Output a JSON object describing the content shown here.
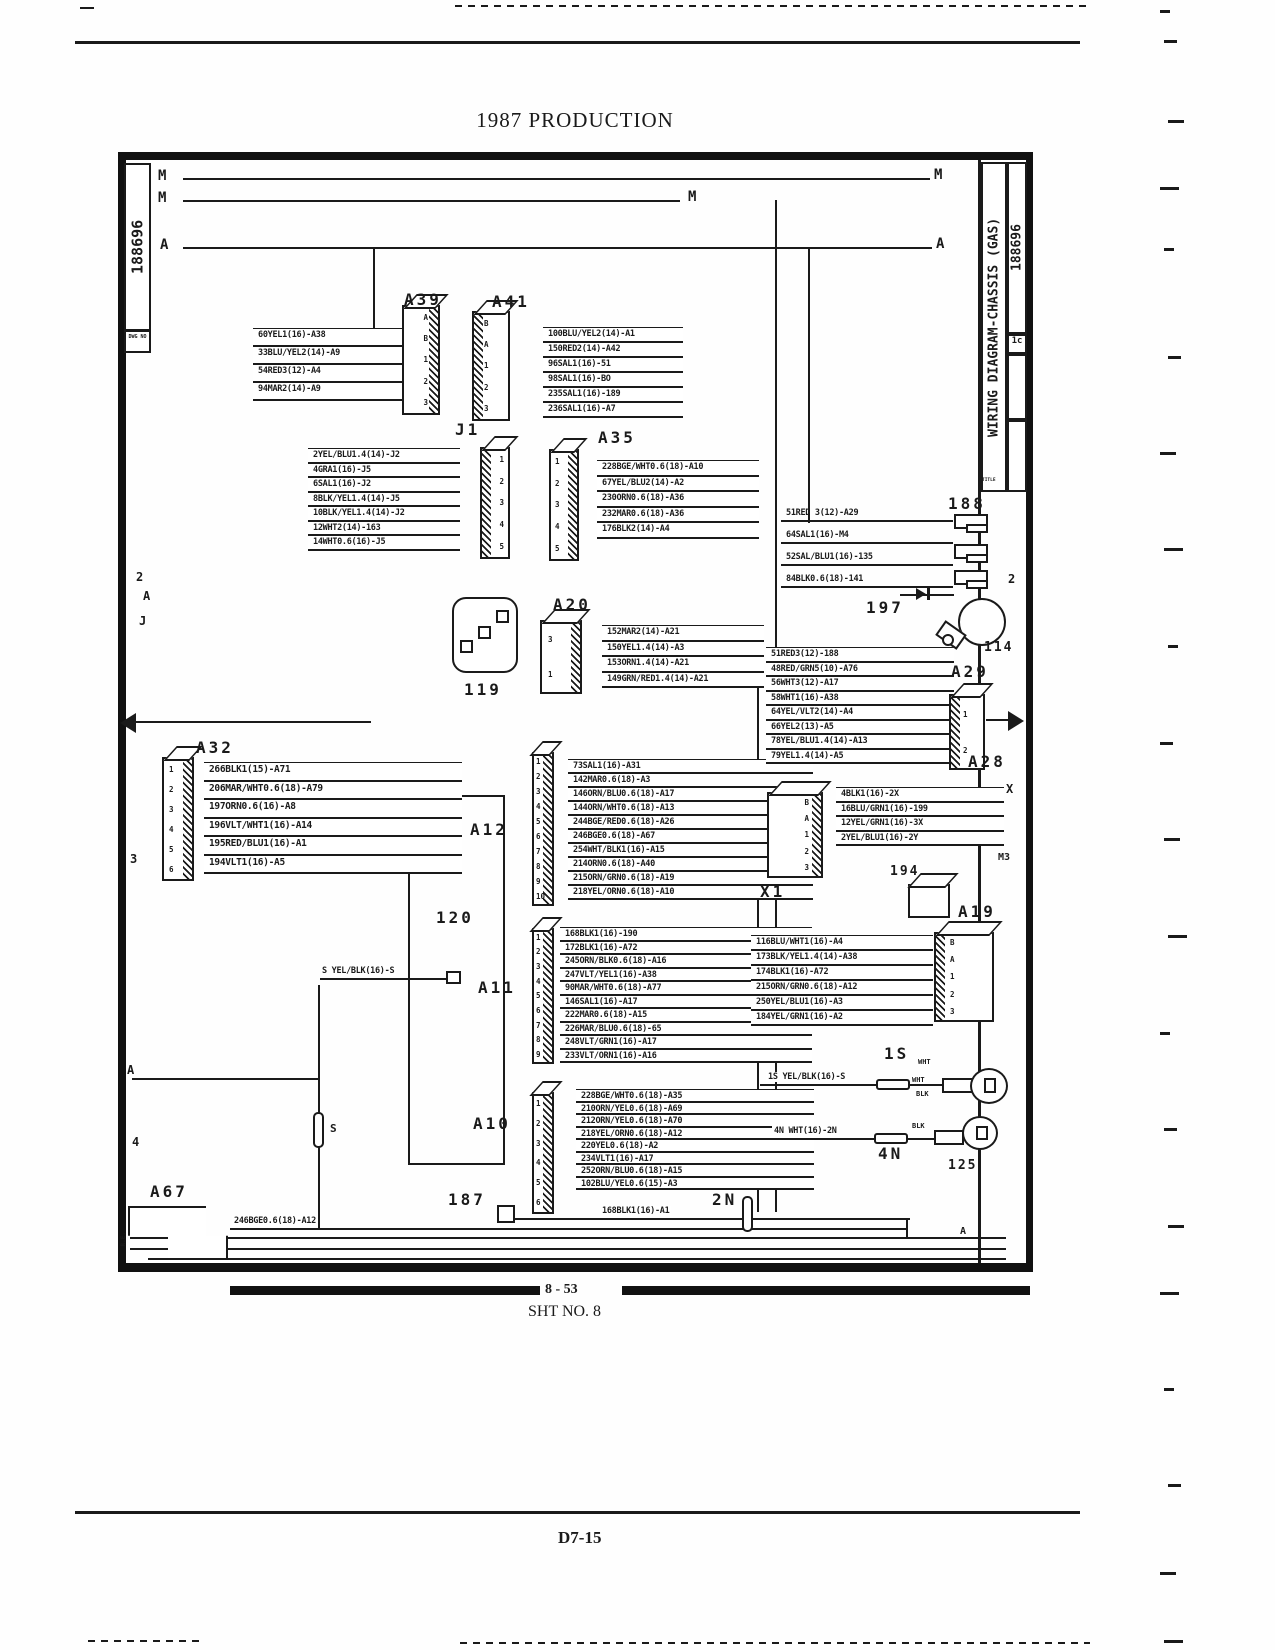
{
  "page": {
    "title": "1987 PRODUCTION",
    "bar": "8 - 53",
    "sheet": "SHT NO. 8",
    "footer": "D7-15"
  },
  "frame": {
    "doc_no_left": "188696",
    "dwg_label_left": "DWG NO",
    "title_vertical": "WIRING DIAGRAM-CHASSIS (GAS)",
    "title_label": "TITLE",
    "doc_no_right": "188696",
    "rev": "1c",
    "corner_note": "R.E."
  },
  "busses": {
    "left": [
      "M",
      "M",
      "A"
    ],
    "mid": "M",
    "right": [
      "M",
      "A"
    ]
  },
  "markers": {
    "left": [
      "2",
      "A",
      "J",
      "3",
      "A",
      "4"
    ],
    "right": [
      "2",
      "X",
      "M3",
      "A"
    ]
  },
  "groups": {
    "A39": {
      "title": "A39",
      "pins": [
        "A",
        "B",
        "1",
        "2",
        "3"
      ],
      "wires": [
        "60YEL1(16)-A38",
        "33BLU/YEL2(14)-A9",
        "54RED3(12)-A4",
        "94MAR2(14)-A9"
      ]
    },
    "A41": {
      "title": "A41",
      "pins": [
        "B",
        "A",
        "1",
        "2",
        "3"
      ],
      "wires": [
        "100BLU/YEL2(14)-A1",
        "150RED2(14)-A42",
        "96SAL1(16)-51",
        "98SAL1(16)-BO",
        "235SAL1(16)-189",
        "236SAL1(16)-A7"
      ]
    },
    "J1": {
      "title": "J1",
      "pins": [
        "1",
        "2",
        "3",
        "4",
        "5"
      ],
      "wires": [
        "2YEL/BLU1.4(14)-J2",
        "4GRA1(16)-J5",
        "6SAL1(16)-J2",
        "8BLK/YEL1.4(14)-J5",
        "10BLK/YEL1.4(14)-J2",
        "12WHT2(14)-163",
        "14WHT0.6(16)-J5"
      ]
    },
    "A35": {
      "title": "A35",
      "pins": [
        "1",
        "2",
        "3",
        "4",
        "5"
      ],
      "wires": [
        "228BGE/WHT0.6(18)-A10",
        "67YEL/BLU2(14)-A2",
        "230ORN0.6(18)-A36",
        "232MAR0.6(18)-A36",
        "176BLK2(14)-A4"
      ]
    },
    "A20": {
      "title": "A20",
      "pins": [
        "3",
        "1"
      ],
      "wires": [
        "152MAR2(14)-A21",
        "150YEL1.4(14)-A3",
        "153ORN1.4(14)-A21",
        "149GRN/RED1.4(14)-A21"
      ]
    },
    "c119": {
      "title": "119"
    },
    "A32": {
      "title": "A32",
      "pins": [
        "1",
        "2",
        "3",
        "4",
        "5",
        "6"
      ],
      "wires": [
        "266BLK1(15)-A71",
        "206MAR/WHT0.6(18)-A79",
        "197ORN0.6(16)-A8",
        "196VLT/WHT1(16)-A14",
        "195RED/BLU1(16)-A1",
        "194VLT1(16)-A5"
      ]
    },
    "A12": {
      "title": "A12",
      "pins": [
        "1",
        "2",
        "3",
        "4",
        "5",
        "6",
        "7",
        "8",
        "9",
        "10"
      ],
      "wires": [
        "73SAL1(16)-A31",
        "142MAR0.6(18)-A3",
        "146ORN/BLU0.6(18)-A17",
        "144ORN/WHT0.6(18)-A13",
        "244BGE/RED0.6(18)-A26",
        "246BGE0.6(18)-A67",
        "254WHT/BLK1(16)-A15",
        "214ORN0.6(18)-A40",
        "215ORN/GRN0.6(18)-A19",
        "218YEL/ORN0.6(18)-A10"
      ]
    },
    "c120": {
      "title": "120"
    },
    "A11": {
      "title": "A11",
      "pins": [
        "1",
        "2",
        "3",
        "4",
        "5",
        "6",
        "7",
        "8",
        "9"
      ],
      "wires": [
        "168BLK1(16)-190",
        "172BLK1(16)-A72",
        "245ORN/BLK0.6(18)-A16",
        "247VLT/YEL1(16)-A38",
        "90MAR/WHT0.6(18)-A77",
        "146SAL1(16)-A17",
        "222MAR0.6(18)-A15",
        "226MAR/BLU0.6(18)-65",
        "248VLT/GRN1(16)-A17",
        "233VLT/ORN1(16)-A16"
      ]
    },
    "A10": {
      "title": "A10",
      "pins": [
        "1",
        "2",
        "3",
        "4",
        "5",
        "6"
      ],
      "wires": [
        "228BGE/WHT0.6(18)-A35",
        "210ORN/YEL0.6(18)-A69",
        "212ORN/YEL0.6(18)-A70",
        "218YEL/ORN0.6(18)-A12",
        "220YEL0.6(18)-A2",
        "234VLT1(16)-A17",
        "252ORN/BLU0.6(18)-A15",
        "102BLU/YEL0.6(15)-A3"
      ]
    },
    "X1": {
      "title": "X1",
      "pins": [
        "B",
        "A",
        "1",
        "2",
        "3"
      ],
      "wires": [
        "4BLK1(16)-2X",
        "16BLU/GRN1(16)-199",
        "12YEL/GRN1(16)-3X",
        "2YEL/BLU1(16)-2Y"
      ]
    },
    "A29": {
      "title": "A29",
      "pins": [
        "1",
        "2"
      ],
      "wires": [
        "51RED3(12)-188",
        "48RED/GRN5(10)-A76",
        "56WHT3(12)-A17",
        "58WHT1(16)-A38",
        "64YEL/VLT2(14)-A4",
        "66YEL2(13)-A5",
        "78YEL/BLU1.4(14)-A13",
        "79YEL1.4(14)-A5"
      ]
    },
    "A28": {
      "title": "A28"
    },
    "r188": {
      "title": "188",
      "wires": [
        "51RED 3(12)-A29",
        "64SAL1(16)-M4",
        "52SAL/BLU1(16)-135",
        "84BLK0.6(18)-141"
      ]
    },
    "c197": {
      "title": "197"
    },
    "c114": {
      "title": "114"
    },
    "c194": {
      "title": "194"
    },
    "A19": {
      "title": "A19",
      "pins": [
        "B",
        "A",
        "1",
        "2",
        "3"
      ],
      "wires": [
        "116BLU/WHT1(16)-A4",
        "173BLK/YEL1.4(14)-A38",
        "174BLK1(16)-A72",
        "215ORN/GRN0.6(18)-A12",
        "250YEL/BLU1(16)-A3",
        "184YEL/GRN1(16)-A2"
      ]
    },
    "s1S": {
      "title": "1S",
      "wire": "1S YEL/BLK(16)-S",
      "tags": [
        "WHT",
        "WHT",
        "BLK"
      ]
    },
    "s4N": {
      "title": "4N",
      "wire": "4N WHT(16)-2N",
      "tag": "BLK"
    },
    "c125": {
      "title": "125"
    },
    "A67": {
      "title": "A67",
      "wire": "246BGE0.6(18)-A12"
    },
    "c187": {
      "title": "187",
      "wire": "168BLK1(16)-A1"
    },
    "c2N": {
      "title": "2N"
    },
    "sS": {
      "wire": "S YEL/BLK(16)-S",
      "cap": "S"
    }
  }
}
